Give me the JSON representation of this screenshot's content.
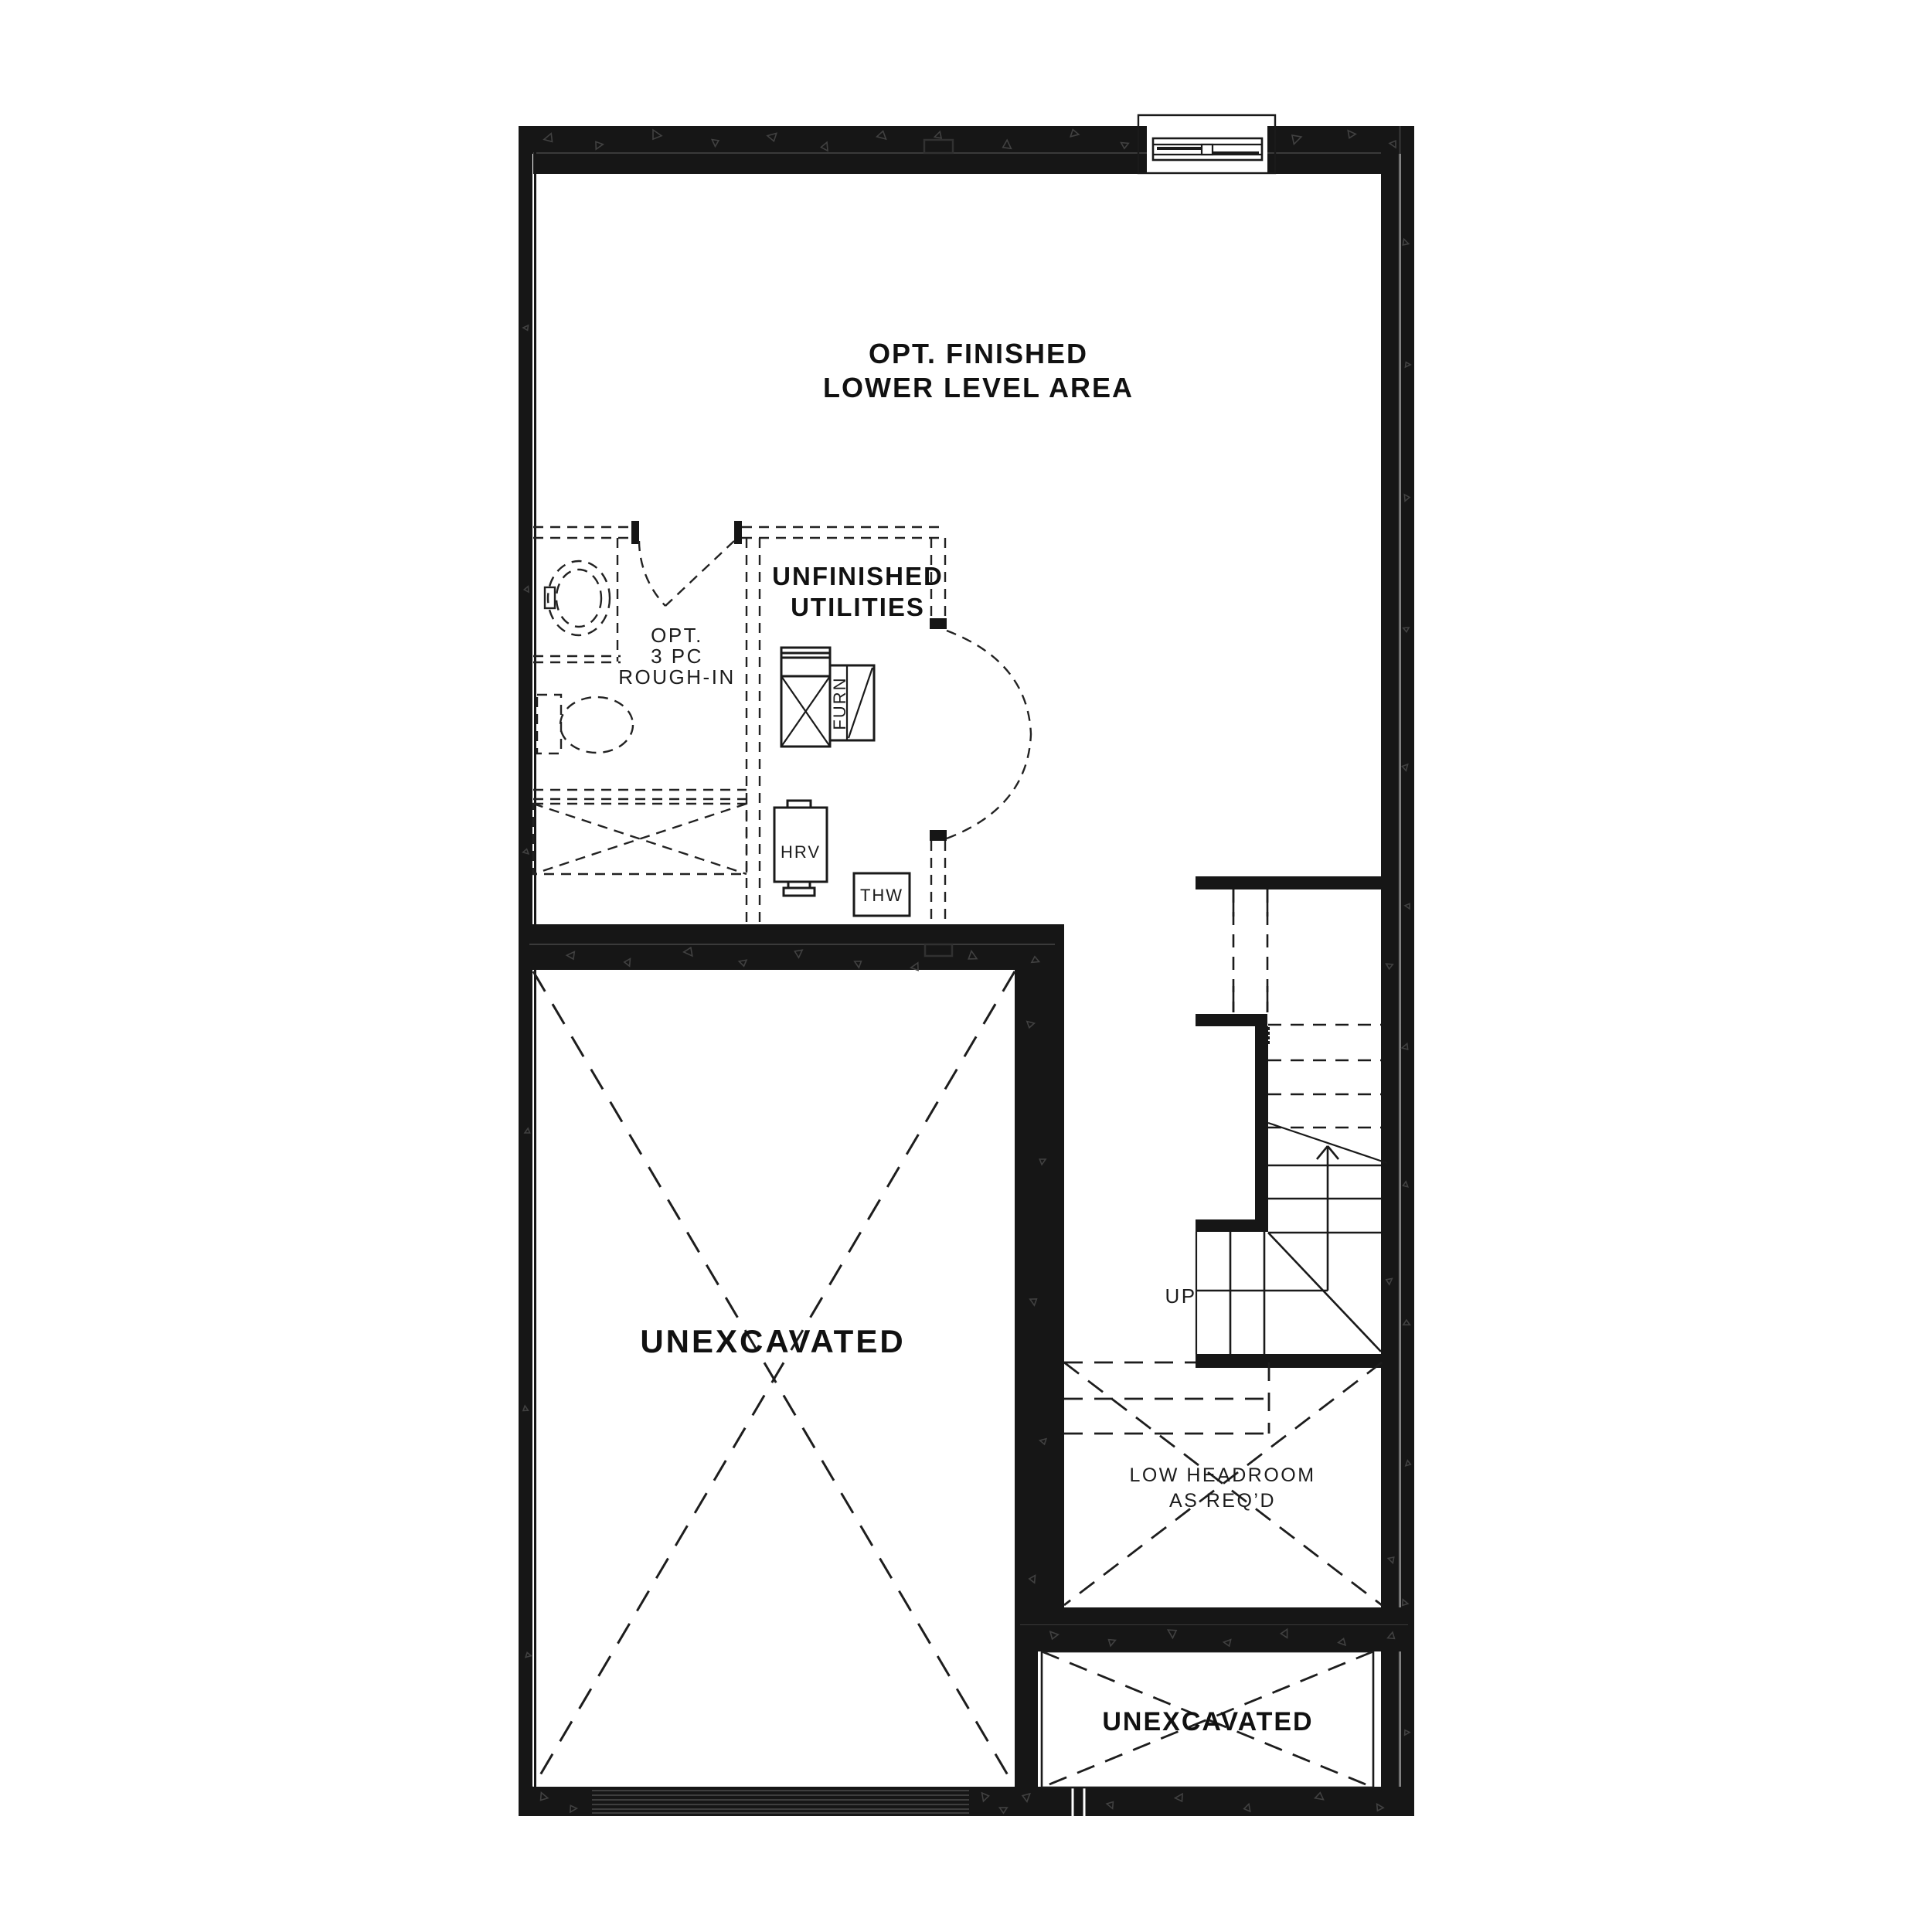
{
  "colors": {
    "background": "#ffffff",
    "wall": "#161616",
    "line": "#1a1a1a",
    "texture_speck": "#414141",
    "text": "#111111"
  },
  "rooms": {
    "finished_area": {
      "line1": "OPT. FINISHED",
      "line2": "LOWER LEVEL AREA"
    },
    "utilities": {
      "line1": "UNFINISHED",
      "line2": "UTILITIES"
    },
    "bath_rough_in": {
      "line1": "OPT.",
      "line2": "3 PC",
      "line3": "ROUGH-IN"
    },
    "unexcavated_main": {
      "label": "UNEXCAVATED"
    },
    "unexcavated_small": {
      "label": "UNEXCAVATED"
    },
    "low_headroom": {
      "line1": "LOW HEADROOM",
      "line2": "AS REQ’D"
    }
  },
  "equipment": {
    "furnace": "FURN",
    "hrv": "HRV",
    "thw": "THW"
  },
  "stairs": {
    "up_label": "UP"
  }
}
